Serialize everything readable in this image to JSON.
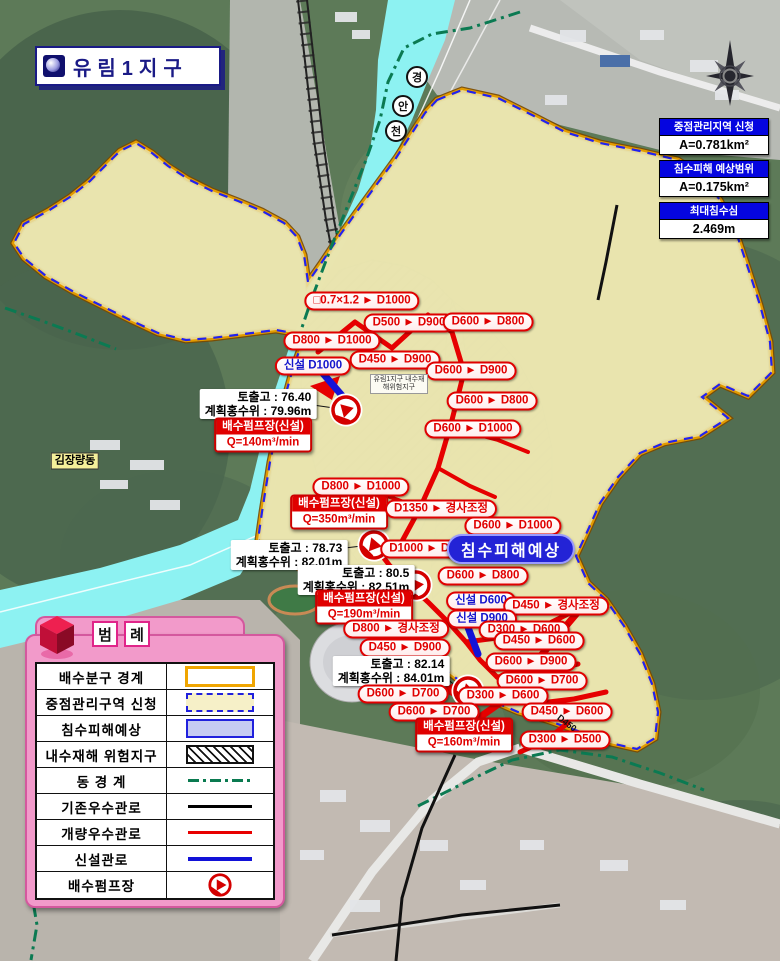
{
  "title": {
    "text": "유림1지구"
  },
  "info_boxes": [
    {
      "header": "중점관리지역 신청",
      "value": "A=0.781km²"
    },
    {
      "header": "침수피해 예상범위",
      "value": "A=0.175km²"
    },
    {
      "header": "최대침수심",
      "value": "2.469m"
    }
  ],
  "legend": {
    "title": "범례",
    "rows": [
      {
        "label": "배수분구 경계",
        "symbol": "district"
      },
      {
        "label": "중점관리구역 신청",
        "symbol": "focus"
      },
      {
        "label": "침수피해예상",
        "symbol": "flood"
      },
      {
        "label": "내수재해 위험지구",
        "symbol": "hazard"
      },
      {
        "label": "동 경 계",
        "symbol": "dong"
      },
      {
        "label": "기존우수관로",
        "symbol": "existing"
      },
      {
        "label": "개량우수관로",
        "symbol": "improved"
      },
      {
        "label": "신설관로",
        "symbol": "newpipe"
      },
      {
        "label": "배수펌프장",
        "symbol": "pump"
      }
    ]
  },
  "colors": {
    "boundary_orange": "#e39b00",
    "focus_dash_blue": "#2222ee",
    "flood_fill": "#b2b6ea",
    "improved_pipe_red": "#e60000",
    "new_pipe_blue": "#1313d8",
    "existing_pipe_black": "#111111",
    "dong_green": "#0b7a52",
    "river_cyan": "#8df2f2",
    "legend_pink": "#f29aca"
  },
  "map_labels": [
    {
      "type": "pipe",
      "text": "□0.7×1.2 ► D1000",
      "x": 362,
      "y": 301
    },
    {
      "type": "pipe",
      "text": "D500 ► D900",
      "x": 409,
      "y": 323
    },
    {
      "type": "pipe",
      "text": "D600 ► D800",
      "x": 488,
      "y": 322
    },
    {
      "type": "pipe",
      "text": "D800 ► D1000",
      "x": 332,
      "y": 341
    },
    {
      "type": "pipe-blue",
      "text": "신설 D1000",
      "x": 313,
      "y": 366
    },
    {
      "type": "pipe",
      "text": "D450 ► D900",
      "x": 395,
      "y": 360
    },
    {
      "type": "pipe",
      "text": "D600 ► D900",
      "x": 471,
      "y": 371
    },
    {
      "type": "pipe",
      "text": "D600 ► D800",
      "x": 492,
      "y": 401
    },
    {
      "type": "pipe",
      "text": "D600 ► D1000",
      "x": 473,
      "y": 429
    },
    {
      "type": "pipe",
      "text": "D800 ► D1000",
      "x": 361,
      "y": 487
    },
    {
      "type": "elev",
      "line1": "토출고 : 76.40",
      "line2": "계획홍수위 : 79.96m",
      "x": 258,
      "y": 404
    },
    {
      "type": "pump",
      "title": "배수펌프장(신설)",
      "value": "Q=140m³/min",
      "x": 263,
      "y": 435
    },
    {
      "type": "pump",
      "title": "배수펌프장(신설)",
      "value": "Q=350m³/min",
      "x": 339,
      "y": 512
    },
    {
      "type": "pipe",
      "text": "D1350 ► 경사조정",
      "x": 441,
      "y": 509
    },
    {
      "type": "pipe",
      "text": "D600 ► D1000",
      "x": 513,
      "y": 526
    },
    {
      "type": "elev",
      "line1": "토출고 : 78.73",
      "line2": "계획홍수위 : 82.01m",
      "x": 289,
      "y": 555
    },
    {
      "type": "pipe",
      "text": "D1000 ► D1350",
      "x": 432,
      "y": 549
    },
    {
      "type": "flood",
      "text": "침수피해예상",
      "x": 511,
      "y": 549
    },
    {
      "type": "pipe",
      "text": "D600 ► D800",
      "x": 483,
      "y": 576
    },
    {
      "type": "elev",
      "line1": "토출고 : 80.5",
      "line2": "계획홍수위 : 82.51m",
      "x": 356,
      "y": 580
    },
    {
      "type": "pump",
      "title": "배수펌프장(신설)",
      "value": "Q=190m³/min",
      "x": 364,
      "y": 607
    },
    {
      "type": "pipe-blue",
      "text": "신설 D600",
      "x": 481,
      "y": 601
    },
    {
      "type": "pipe",
      "text": "D450 ► 경사조정",
      "x": 556,
      "y": 606
    },
    {
      "type": "pipe-blue",
      "text": "신설 D900",
      "x": 482,
      "y": 619
    },
    {
      "type": "pipe",
      "text": "D300 ► D600",
      "x": 524,
      "y": 630
    },
    {
      "type": "pipe",
      "text": "D800 ► 경사조정",
      "x": 396,
      "y": 629
    },
    {
      "type": "pipe",
      "text": "D450 ► D600",
      "x": 539,
      "y": 641
    },
    {
      "type": "pipe",
      "text": "D450 ► D900",
      "x": 405,
      "y": 648
    },
    {
      "type": "pipe",
      "text": "D600 ► D900",
      "x": 531,
      "y": 662
    },
    {
      "type": "elev",
      "line1": "토출고 : 82.14",
      "line2": "계획홍수위 : 84.01m",
      "x": 391,
      "y": 671
    },
    {
      "type": "pipe",
      "text": "D600 ► D700",
      "x": 542,
      "y": 681
    },
    {
      "type": "pipe",
      "text": "D600 ► D700",
      "x": 403,
      "y": 694
    },
    {
      "type": "pipe",
      "text": "D300 ► D600",
      "x": 503,
      "y": 696
    },
    {
      "type": "pipe",
      "text": "D600 ► D700",
      "x": 434,
      "y": 712
    },
    {
      "type": "pipe",
      "text": "D450 ► D600",
      "x": 567,
      "y": 712
    },
    {
      "type": "pump",
      "title": "배수펌프장(신설)",
      "value": "Q=160m³/min",
      "x": 464,
      "y": 735
    },
    {
      "type": "pipe",
      "text": "D300 ► D500",
      "x": 565,
      "y": 740
    },
    {
      "type": "place",
      "text": "김장량동",
      "x": 75,
      "y": 461
    },
    {
      "type": "rchar",
      "text": "경",
      "x": 417,
      "y": 77
    },
    {
      "type": "rchar",
      "text": "안",
      "x": 403,
      "y": 106
    },
    {
      "type": "rchar",
      "text": "천",
      "x": 396,
      "y": 131
    },
    {
      "type": "tiny",
      "text": "유림1지구 내수재해위험지구",
      "x": 399,
      "y": 384
    },
    {
      "type": "maptext",
      "text": "D450",
      "x": 567,
      "y": 723
    }
  ]
}
